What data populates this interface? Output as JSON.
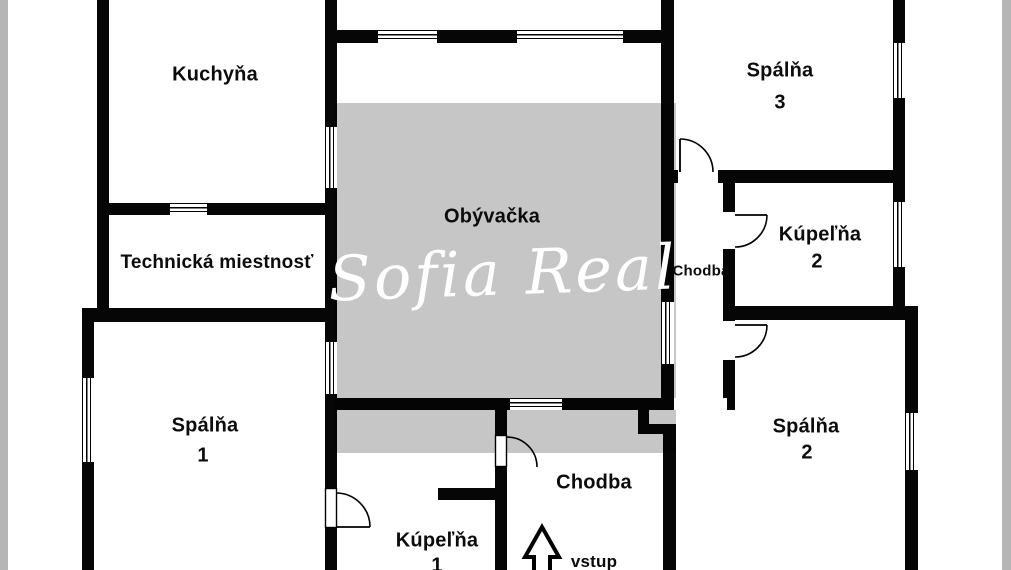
{
  "plan": {
    "watermark": "Sofia Real",
    "entrance_label": "vstup",
    "rooms": {
      "kitchen": {
        "label": "Kuchyňa"
      },
      "bedroom3": {
        "label": "Spálňa",
        "number": "3"
      },
      "technical": {
        "label": "Technická miestnosť"
      },
      "living": {
        "label": "Obývačka"
      },
      "hall_upper": {
        "label": "Chodba"
      },
      "bath2": {
        "label": "Kúpeľňa",
        "number": "2"
      },
      "bedroom1": {
        "label": "Spálňa",
        "number": "1"
      },
      "bedroom2": {
        "label": "Spálňa",
        "number": "2"
      },
      "bath1": {
        "label": "Kúpeľňa",
        "number": "1"
      },
      "hall_lower": {
        "label": "Chodba"
      }
    },
    "colors": {
      "wall": "#060606",
      "overlay_gray": "#c6c6c6",
      "edge_strip": "#b5b5b5"
    }
  }
}
